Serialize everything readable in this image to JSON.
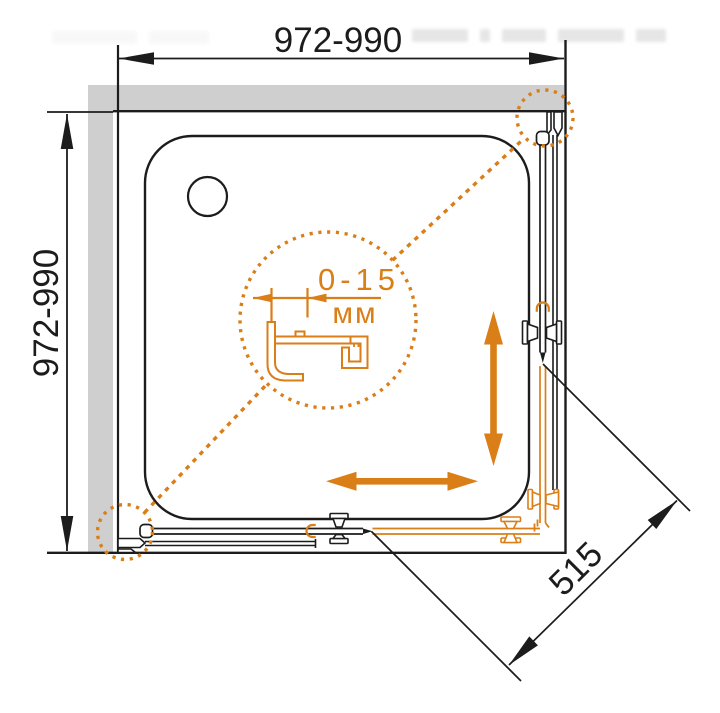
{
  "diagram": {
    "dim_width": "972-990",
    "dim_depth": "972-990",
    "dim_door_diagonal": "515",
    "detail_adjustment_range": "0-15",
    "detail_adjustment_unit": "мм"
  },
  "colors": {
    "accent": "#DA7E17",
    "wall": "#CFCFCF",
    "line": "#1C1C1C",
    "bg": "#FFFFFF",
    "watermark": "#E0E0E0"
  }
}
